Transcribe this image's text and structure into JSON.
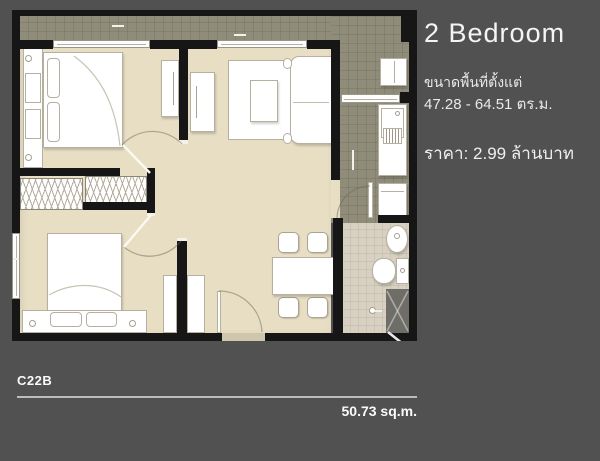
{
  "panel": {
    "title": "2 Bedroom",
    "area_label": "ขนาดพื้นที่ตั้งแต่",
    "area_value": "47.28 - 64.51 ตร.ม.",
    "price": "ราคา: 2.99 ล้านบาท"
  },
  "footer": {
    "unit_code": "C22B",
    "plan_area": "50.73 sq.m."
  },
  "colors": {
    "background": "#525152",
    "wall": "#161616",
    "floor": "#e8dec4",
    "balcony_tile": "#8f8c79",
    "bath_tile": "#d8d1c2",
    "furniture": "#ffffff",
    "shower": "#6e6d68",
    "text": "#f2f2f2",
    "divider": "#bdbdbd"
  }
}
